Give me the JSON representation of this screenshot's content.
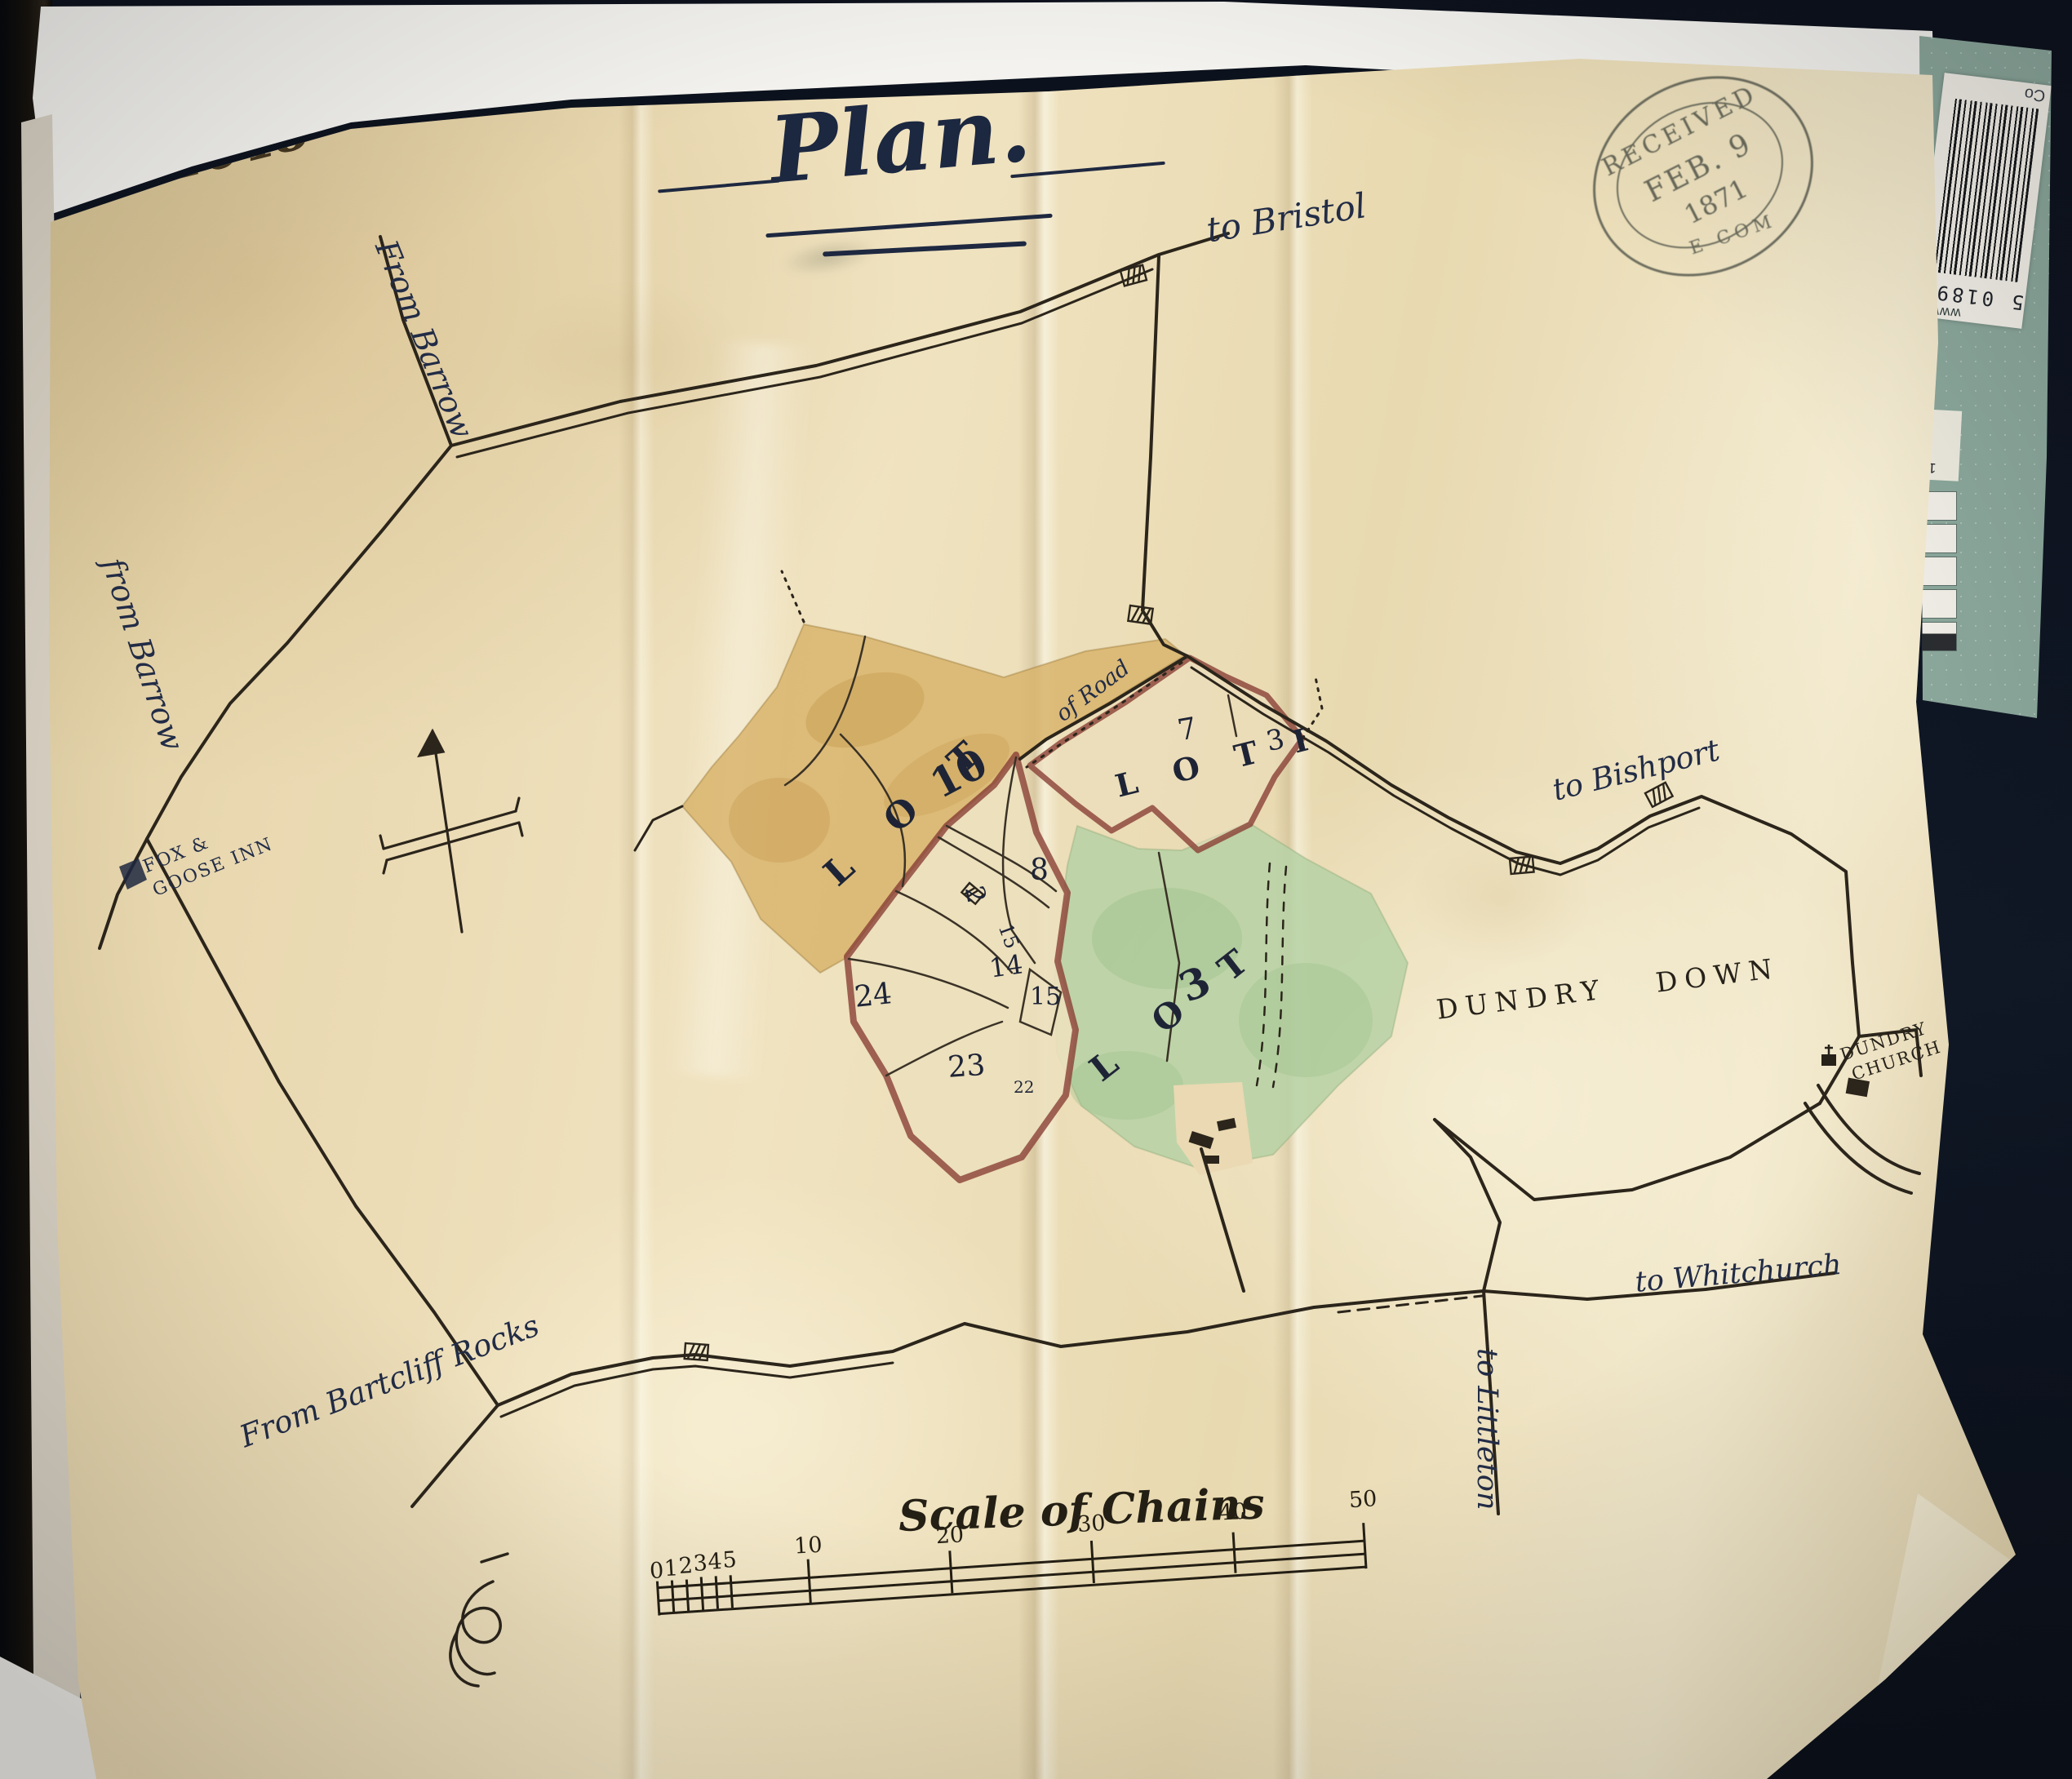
{
  "photo": {
    "background_color": "#0e1420",
    "card": {
      "color": "#8ba79b",
      "barcode_text": "5 01898",
      "barcode_partial": "Co",
      "web_text": "www.",
      "chip_lines": [
        "1000",
        "11",
        "900"
      ]
    }
  },
  "sheet": {
    "number": "1648",
    "title": "Plan.",
    "stamp": {
      "word": "RECEIVED",
      "date": "FEB. 9",
      "year": "1871",
      "rim": "E COM"
    },
    "colors": {
      "vellum": "#e9dab3",
      "ink": "#2b251b",
      "script_ink": "#212c46",
      "boundary": "#8a4036",
      "lot_yellow": "#d8b269",
      "lot_green": "#b7d2a5"
    }
  },
  "map": {
    "roads": {
      "to_bristol": "to Bristol",
      "from_barrow_top": "From Barrow",
      "from_barrow_left": "from Barrow",
      "to_bishport": "to Bishport",
      "to_whitchurch": "to Whitchurch",
      "to_littleton": "to Littleton",
      "from_bartcliff": "From Bartcliff Rocks",
      "of_road": "of Road"
    },
    "places": {
      "fox_goose_line1": "FOX &",
      "fox_goose_line2": "GOOSE INN",
      "dundry_down": "DUNDRY DOWN",
      "dundry_church_line1": "DUNDRY",
      "dundry_church_line2": "CHURCH"
    },
    "lots": {
      "lot10_word": "L O T",
      "lot10_num": "10",
      "lot1": "L O T   I",
      "lot3_word": "L O T",
      "lot3_num": "3"
    },
    "parcels": {
      "p7": "7",
      "p3": "3",
      "p8": "8",
      "p2": "2",
      "p15a": "15",
      "p14": "14",
      "p15b": "15",
      "p24": "24",
      "p23": "23",
      "p22": "22"
    },
    "scale": {
      "title": "Scale of Chains",
      "ticks": [
        "0",
        "1",
        "2",
        "3",
        "4",
        "5",
        "10",
        "20",
        "30",
        "40",
        "50"
      ]
    }
  }
}
